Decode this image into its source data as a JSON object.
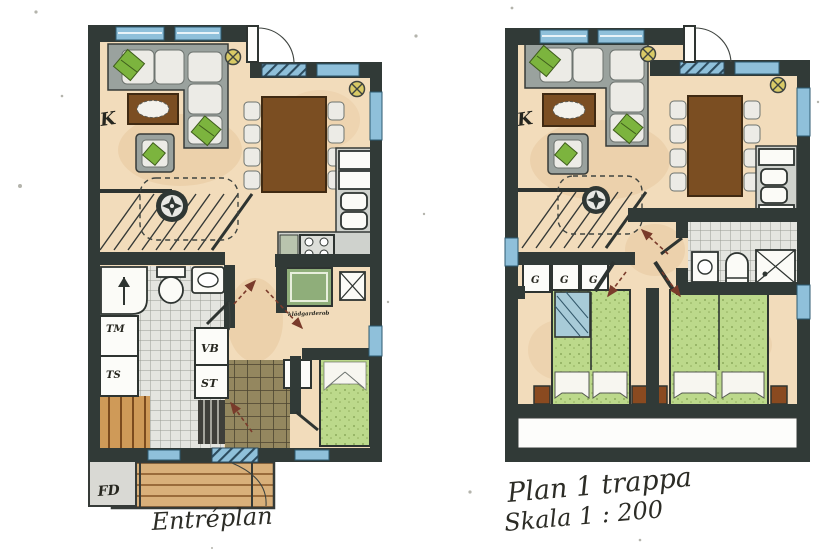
{
  "captions": {
    "left": "Entréplan",
    "right_line1": "Plan 1 trappa",
    "right_line2": "Skala 1 : 200"
  },
  "left_plan": {
    "name": "Entréplan",
    "labels": {
      "k": "K",
      "tm": "TM",
      "ts": "TS",
      "vb": "VB",
      "st": "ST",
      "g": "G",
      "fd": "FD",
      "closet_note": "klädgarderob"
    }
  },
  "right_plan": {
    "name": "Plan 1 trappa",
    "labels": {
      "k": "K",
      "g1": "G",
      "g2": "G",
      "g3": "G"
    }
  },
  "colors": {
    "wall": "#313a37",
    "floor": "#f2dcbb",
    "window": "#8fc0da",
    "table_brown": "#7b4e22",
    "plant": "#7cb43e",
    "lamp": "#d9ca66",
    "arrow": "#7a3b2b",
    "bed_green": "#bcd98b",
    "tile": "#e4e5e0",
    "dark_tile": "#94875f",
    "deck_wood": "#d9b07a"
  }
}
